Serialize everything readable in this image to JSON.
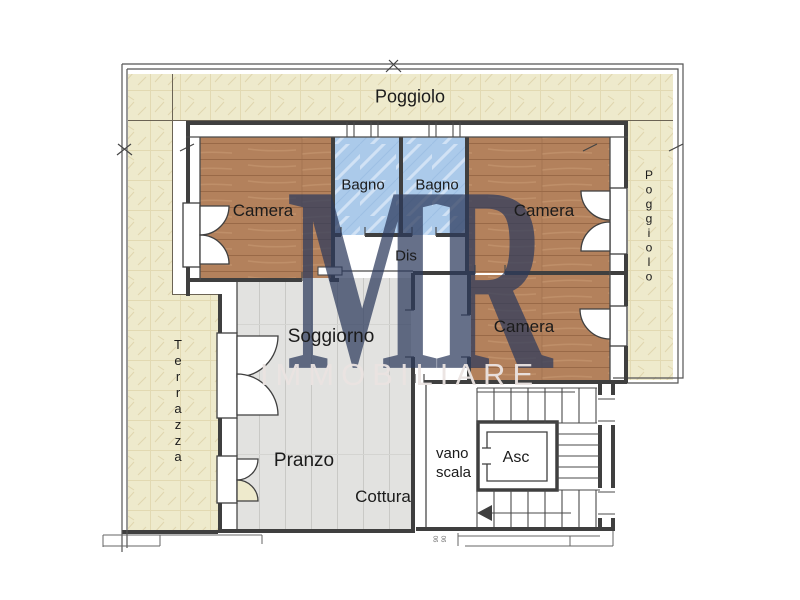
{
  "watermark": {
    "initials": "MR",
    "name": "IMMOBILIARE"
  },
  "rooms": {
    "poggiolo_top": "Poggiolo",
    "camera_nw": "Camera",
    "bagno_left": "Bagno",
    "bagno_right": "Bagno",
    "camera_ne": "Camera",
    "dis": "Dis",
    "camera_e": "Camera",
    "soggiorno": "Soggiorno",
    "terrazza": "Terrazza",
    "pranzo": "Pranzo",
    "cottura": "Cottura",
    "vano": "vano",
    "scala": "scala",
    "asc": "Asc",
    "poggiolo_right": "Poggiolo"
  },
  "dimensions": {
    "d1": "90",
    "d2": "90"
  },
  "colors": {
    "wall": "#3f3f3f",
    "balcony_fill": "#eeeacc",
    "bedroom_fill": "#b3815c",
    "bathroom_fill": "#abcaea",
    "living_fill": "#e2e2e0",
    "watermark_initials": "#2c3a5c",
    "watermark_name": "#ebe4e2",
    "label": "#1b1b1b"
  }
}
